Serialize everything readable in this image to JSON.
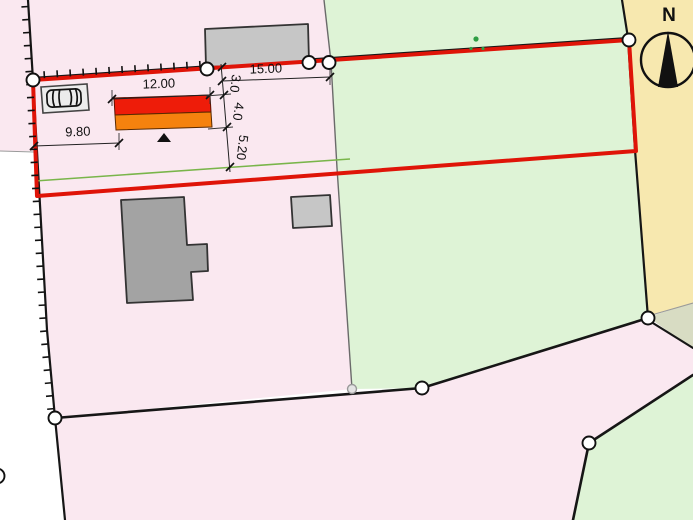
{
  "map": {
    "type": "cadastral-site-plan",
    "compass_label": "N",
    "dimensions": {
      "d9_80": "9.80",
      "d12_00": "12.00",
      "d15_00": "15.00",
      "d3_0": "3.0",
      "d4_0": "4.0",
      "d5_20": "5.20"
    },
    "colors": {
      "parcel_pink": "#fae8f0",
      "parcel_green": "#def3d6",
      "parcel_tan": "#f7e8af",
      "parcel_sage": "#d8dcc3",
      "plot_outline_red": "#df1408",
      "proposal_red": "#ee1c09",
      "proposal_orange": "#f5820e",
      "helper_line_green": "#79b54a",
      "building_gray": "#a3a3a3",
      "building_light_gray": "#c6c6c6",
      "parking_fill": "#ececec"
    }
  }
}
